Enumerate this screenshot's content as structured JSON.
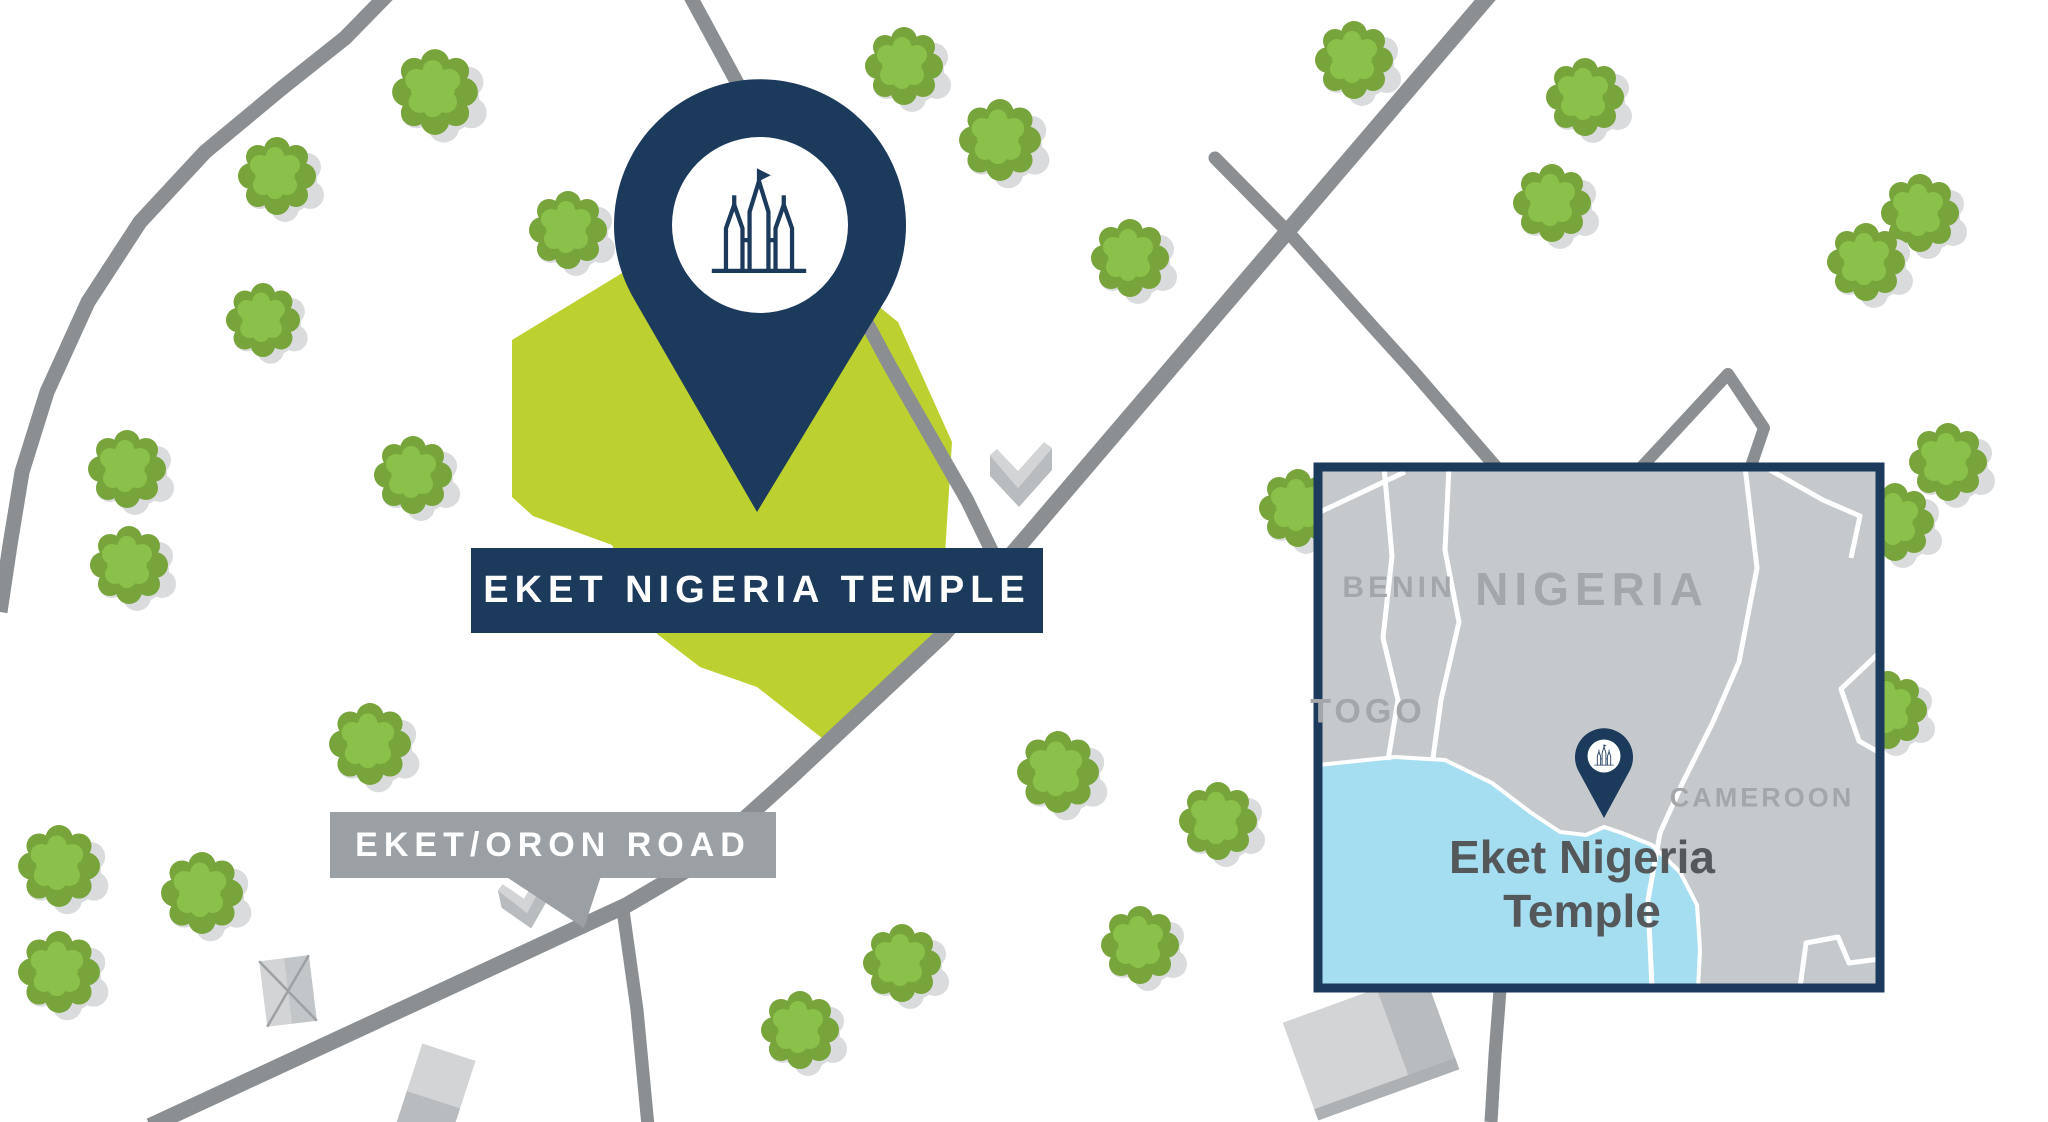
{
  "map": {
    "site_label": "EKET NIGERIA TEMPLE",
    "road_label": "EKET/ORON ROAD"
  },
  "inset": {
    "countries": [
      "BENIN",
      "NIGERIA",
      "TOGO",
      "CAMEROON"
    ],
    "caption_line1": "Eket Nigeria",
    "caption_line2": "Temple"
  },
  "icons": {
    "site_pin": "temple-map-pin",
    "inset_pin": "temple-map-pin",
    "tree": "tree-icon"
  },
  "colors": {
    "navy": "#1b3a5c",
    "site_green": "#bcd02f",
    "tree_green": "#8bc04a",
    "tree_green_dark": "#78a43c",
    "tree_shadow": "#d9dbdc",
    "road_gray": "#8b8f92",
    "banner_gray": "#9aa0a4",
    "land_gray": "#c6c9cb",
    "water_blue": "#a6def1",
    "border_white": "#ffffff",
    "label_gray": "#a3a7aa",
    "caption_gray": "#54585a",
    "building_light": "#d2d4d5",
    "building_mid": "#b9bcbe"
  }
}
